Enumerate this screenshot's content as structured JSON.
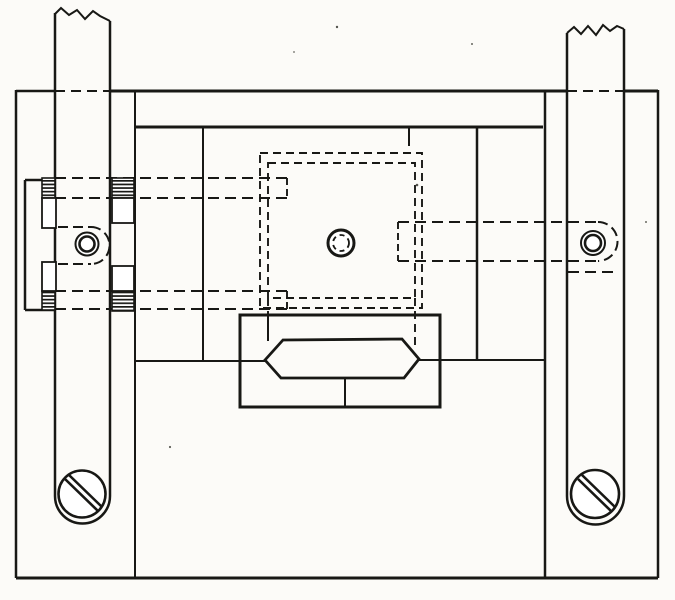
{
  "meta": {
    "description": "Patent-style mechanical line drawing: plan view of a base plate with two vertical slide bars (shown broken at top), a threaded clamp bracket, hidden dashed platform outline with center pivot, and a hexagonal wedge block in a housing",
    "background": "#fcfbf8",
    "ink": "#181815"
  },
  "figure": {
    "width": 675,
    "height": 600,
    "elements": [
      {
        "name": "hidden-rod-upper-top-line",
        "type": "line",
        "x1": 55,
        "y1": 178,
        "x2": 287,
        "y2": 178,
        "dash": "11,6",
        "w": 2
      },
      {
        "name": "hidden-rod-upper-bottom-line",
        "type": "line",
        "x1": 55,
        "y1": 198,
        "x2": 287,
        "y2": 198,
        "dash": "11,6",
        "w": 2
      },
      {
        "name": "hidden-rod-lower-top-line",
        "type": "line",
        "x1": 55,
        "y1": 291,
        "x2": 287,
        "y2": 291,
        "dash": "11,6",
        "w": 2
      },
      {
        "name": "hidden-rod-lower-bottom-line",
        "type": "line",
        "x1": 55,
        "y1": 309,
        "x2": 287,
        "y2": 309,
        "dash": "11,6",
        "w": 2
      },
      {
        "name": "hidden-rod-right-top-line",
        "type": "line",
        "x1": 398,
        "y1": 222,
        "x2": 598,
        "y2": 222,
        "dash": "11,6",
        "w": 2
      },
      {
        "name": "hidden-rod-right-bottom-line",
        "type": "line",
        "x1": 398,
        "y1": 261,
        "x2": 598,
        "y2": 261,
        "dash": "11,6",
        "w": 2
      },
      {
        "name": "hidden-rod-right-end-arc",
        "type": "path",
        "d": "M 598 222 A 19.5 19.5 0 0 1 598 261",
        "dash": "10,5",
        "w": 2
      },
      {
        "name": "hidden-edge-below-right-screw",
        "type": "line",
        "x1": 568,
        "y1": 272,
        "x2": 618,
        "y2": 272,
        "dash": "11,6",
        "w": 2
      },
      {
        "name": "left-screw-hidden-slot-top",
        "type": "line",
        "x1": 58,
        "y1": 227,
        "x2": 91,
        "y2": 227,
        "dash": "10,5",
        "w": 2
      },
      {
        "name": "left-screw-hidden-slot-bottom",
        "type": "line",
        "x1": 58,
        "y1": 264,
        "x2": 91,
        "y2": 264,
        "dash": "10,5",
        "w": 2
      },
      {
        "name": "left-screw-hidden-slot-arc",
        "type": "path",
        "d": "M 91 227 A 18.5 18.5 0 0 1 91 264",
        "dash": "10,5",
        "w": 2
      },
      {
        "name": "platform-hidden-outline-outer",
        "type": "rect",
        "x": 260,
        "y": 153,
        "width": 162,
        "height": 155,
        "dash": "8,5",
        "w": 1.9
      },
      {
        "name": "platform-hidden-outline-inner",
        "type": "rect",
        "x": 268,
        "y": 163,
        "width": 147,
        "height": 135,
        "dash": "8,5",
        "w": 1.9
      },
      {
        "name": "platform-notch-top-left",
        "type": "line",
        "x1": 287,
        "y1": 178,
        "x2": 287,
        "y2": 198,
        "dash": "7,4",
        "w": 1.9
      },
      {
        "name": "platform-notch-bottom-left",
        "type": "line",
        "x1": 287,
        "y1": 291,
        "x2": 287,
        "y2": 309,
        "dash": "7,4",
        "w": 1.9
      },
      {
        "name": "platform-notch-right",
        "type": "line",
        "x1": 398,
        "y1": 222,
        "x2": 398,
        "y2": 261,
        "dash": "7,4",
        "w": 1.9
      },
      {
        "name": "platform-inner-right-extension",
        "type": "line",
        "x1": 415,
        "y1": 298,
        "x2": 415,
        "y2": 345,
        "dash": "8,5",
        "w": 1.9
      },
      {
        "name": "platform-inner-left-extension",
        "type": "line",
        "x1": 268,
        "y1": 298,
        "x2": 268,
        "y2": 315,
        "dash": "8,5",
        "w": 1.9
      },
      {
        "name": "plate-top-edge-hidden-behind-left-bar",
        "type": "line",
        "x1": 55,
        "y1": 91,
        "x2": 110,
        "y2": 91,
        "dash": "10,6",
        "w": 2
      },
      {
        "name": "plate-top-edge-hidden-behind-right-bar",
        "type": "line",
        "x1": 567,
        "y1": 91,
        "x2": 624,
        "y2": 91,
        "dash": "10,6",
        "w": 2
      },
      {
        "name": "plate-top-edge-left-segment",
        "type": "line",
        "x1": 16,
        "y1": 91,
        "x2": 55,
        "y2": 91,
        "w": 2.5
      },
      {
        "name": "plate-top-edge-middle-segment",
        "type": "line",
        "x1": 110,
        "y1": 91,
        "x2": 567,
        "y2": 91,
        "w": 3
      },
      {
        "name": "plate-top-edge-right-segment",
        "type": "line",
        "x1": 624,
        "y1": 91,
        "x2": 658,
        "y2": 91,
        "w": 3
      },
      {
        "name": "plate-left-edge",
        "type": "line",
        "x1": 16,
        "y1": 90,
        "x2": 16,
        "y2": 578,
        "w": 2.5
      },
      {
        "name": "plate-bottom-edge",
        "type": "line",
        "x1": 16,
        "y1": 578,
        "x2": 658,
        "y2": 578,
        "w": 3
      },
      {
        "name": "plate-right-edge",
        "type": "line",
        "x1": 658,
        "y1": 90,
        "x2": 658,
        "y2": 578,
        "w": 2.5
      },
      {
        "name": "plate-inner-left-edge",
        "type": "line",
        "x1": 135,
        "y1": 91,
        "x2": 135,
        "y2": 578,
        "w": 2
      },
      {
        "name": "plate-inner-right-edge",
        "type": "line",
        "x1": 545,
        "y1": 91,
        "x2": 545,
        "y2": 578,
        "w": 2.5
      },
      {
        "name": "top-rail-lower-edge",
        "type": "line",
        "x1": 135,
        "y1": 127,
        "x2": 543,
        "y2": 127,
        "w": 3
      },
      {
        "name": "recess-left-edge",
        "type": "line",
        "x1": 203,
        "y1": 127,
        "x2": 203,
        "y2": 361,
        "w": 2
      },
      {
        "name": "recess-right-edge",
        "type": "line",
        "x1": 477,
        "y1": 127,
        "x2": 477,
        "y2": 360,
        "w": 2.5
      },
      {
        "name": "recess-edge-tick",
        "type": "line",
        "x1": 409,
        "y1": 127,
        "x2": 409,
        "y2": 146,
        "w": 2
      },
      {
        "name": "recess-mid-left-ledge",
        "type": "line",
        "x1": 135,
        "y1": 361,
        "x2": 265,
        "y2": 361,
        "w": 2
      },
      {
        "name": "recess-mid-right-ledge",
        "type": "line",
        "x1": 419,
        "y1": 360,
        "x2": 545,
        "y2": 360,
        "w": 2
      },
      {
        "name": "wedge-housing-outline",
        "type": "rect",
        "x": 240,
        "y": 315,
        "width": 200,
        "height": 92,
        "w": 3
      },
      {
        "name": "wedge-housing-inner-edge",
        "type": "line",
        "x1": 268,
        "y1": 315,
        "x2": 268,
        "y2": 341,
        "w": 2
      },
      {
        "name": "wedge-housing-center-rib",
        "type": "line",
        "x1": 345,
        "y1": 378,
        "x2": 345,
        "y2": 407,
        "w": 2
      },
      {
        "name": "wedge-block-outline",
        "type": "polygon",
        "points": "265,360 283,340 402,339 419,359 404,378 281,378",
        "w": 2.8
      },
      {
        "name": "clamp-bracket-outer-edge",
        "type": "line",
        "x1": 25,
        "y1": 180,
        "x2": 25,
        "y2": 310,
        "w": 2.5
      },
      {
        "name": "clamp-bracket-top-edge",
        "type": "line",
        "x1": 25,
        "y1": 180,
        "x2": 55,
        "y2": 180,
        "w": 2.5
      },
      {
        "name": "clamp-bracket-bottom-edge",
        "type": "line",
        "x1": 25,
        "y1": 310,
        "x2": 55,
        "y2": 310,
        "w": 2.5
      },
      {
        "name": "left-slide-bar-left-edge",
        "type": "line",
        "x1": 55,
        "y1": 13,
        "x2": 55,
        "y2": 496,
        "w": 2.5
      },
      {
        "name": "left-slide-bar-right-edge",
        "type": "line",
        "x1": 110,
        "y1": 21,
        "x2": 110,
        "y2": 496,
        "w": 2.5
      },
      {
        "name": "left-slide-bar-break-line",
        "type": "polyline",
        "points": "55,14 61,8 69,15 77,10 85,19 93,11 100,16 110,21",
        "w": 2
      },
      {
        "name": "left-slide-bar-round-end",
        "type": "path",
        "d": "M 55 496 A 27.5 27.5 0 0 0 110 496",
        "w": 2.5
      },
      {
        "name": "right-slide-bar-left-edge",
        "type": "line",
        "x1": 567,
        "y1": 33,
        "x2": 567,
        "y2": 496,
        "w": 2.5
      },
      {
        "name": "right-slide-bar-right-edge",
        "type": "line",
        "x1": 624,
        "y1": 29,
        "x2": 624,
        "y2": 496,
        "w": 2.5
      },
      {
        "name": "right-slide-bar-break-line",
        "type": "polyline",
        "points": "567,33 574,27 581,34 588,26 596,35 603,25 610,31 617,26 624,29",
        "w": 2
      },
      {
        "name": "right-slide-bar-round-end",
        "type": "path",
        "d": "M 567 496 A 28.5 28.5 0 0 0 624 496",
        "w": 2.5
      },
      {
        "name": "thread-block-upper-left",
        "type": "rect",
        "x": 42,
        "y": 178,
        "width": 13,
        "height": 20,
        "fill": "hatch",
        "w": 1.6
      },
      {
        "name": "thread-block-upper-right",
        "type": "rect",
        "x": 112,
        "y": 178,
        "width": 22,
        "height": 20,
        "fill": "hatch",
        "w": 1.6
      },
      {
        "name": "thread-block-lower-left",
        "type": "rect",
        "x": 42,
        "y": 291,
        "width": 13,
        "height": 19,
        "fill": "hatch",
        "w": 1.6
      },
      {
        "name": "thread-block-lower-right",
        "type": "rect",
        "x": 112,
        "y": 291,
        "width": 22,
        "height": 20,
        "fill": "hatch",
        "w": 1.6
      },
      {
        "name": "shank-box-upper-left",
        "type": "rect",
        "x": 42,
        "y": 198,
        "width": 14,
        "height": 30,
        "fill": "#ffffff",
        "w": 1.8
      },
      {
        "name": "shank-box-upper-right",
        "type": "rect",
        "x": 112,
        "y": 198,
        "width": 22,
        "height": 25,
        "fill": "#ffffff",
        "w": 1.8
      },
      {
        "name": "shank-box-lower-left",
        "type": "rect",
        "x": 42,
        "y": 262,
        "width": 14,
        "height": 29,
        "fill": "#ffffff",
        "w": 1.8
      },
      {
        "name": "shank-box-lower-right",
        "type": "rect",
        "x": 112,
        "y": 266,
        "width": 22,
        "height": 25,
        "fill": "#ffffff",
        "w": 1.8
      },
      {
        "name": "left-guide-screw-outer-ring",
        "type": "circle",
        "cx": 87,
        "cy": 244,
        "r": 11.5,
        "w": 2,
        "fill": "#ffffff"
      },
      {
        "name": "left-guide-screw-inner-ring",
        "type": "circle",
        "cx": 87,
        "cy": 244,
        "r": 7.5,
        "w": 2.6
      },
      {
        "name": "right-guide-screw-outer-ring",
        "type": "circle",
        "cx": 593,
        "cy": 243,
        "r": 12,
        "w": 2,
        "fill": "#ffffff"
      },
      {
        "name": "right-guide-screw-inner-ring",
        "type": "circle",
        "cx": 593,
        "cy": 243,
        "r": 8,
        "w": 2.6
      },
      {
        "name": "center-pivot-outer-ring",
        "type": "circle",
        "cx": 341,
        "cy": 243,
        "r": 13,
        "w": 3,
        "fill": "#ffffff"
      },
      {
        "name": "center-pivot-inner-dashed-ring",
        "type": "circle",
        "cx": 341,
        "cy": 243,
        "r": 8,
        "w": 1.8,
        "dash": "5,4"
      },
      {
        "name": "left-clamp-screw-head",
        "type": "circle",
        "cx": 82,
        "cy": 494,
        "r": 23.5,
        "w": 2.6,
        "fill": "#ffffff"
      },
      {
        "name": "left-clamp-screw-slot-a",
        "type": "line",
        "x1": 65,
        "y1": 479,
        "x2": 98,
        "y2": 511,
        "w": 2.6
      },
      {
        "name": "left-clamp-screw-slot-b",
        "type": "line",
        "x1": 69,
        "y1": 475,
        "x2": 102,
        "y2": 507,
        "w": 2.6
      },
      {
        "name": "right-clamp-screw-head",
        "type": "circle",
        "cx": 595,
        "cy": 494,
        "r": 24,
        "w": 2.6,
        "fill": "#ffffff"
      },
      {
        "name": "right-clamp-screw-slot-a",
        "type": "line",
        "x1": 578,
        "y1": 479,
        "x2": 611,
        "y2": 511,
        "w": 2.6
      },
      {
        "name": "right-clamp-screw-slot-b",
        "type": "line",
        "x1": 582,
        "y1": 475,
        "x2": 615,
        "y2": 507,
        "w": 2.6
      },
      {
        "name": "scan-speck-1",
        "type": "circle",
        "cx": 337,
        "cy": 27,
        "r": 1.2,
        "w": 0,
        "fill": "#555550"
      },
      {
        "name": "scan-speck-2",
        "type": "circle",
        "cx": 472,
        "cy": 44,
        "r": 1.0,
        "w": 0,
        "fill": "#66665f"
      },
      {
        "name": "scan-speck-3",
        "type": "circle",
        "cx": 417,
        "cy": 185,
        "r": 1.3,
        "w": 0,
        "fill": "#55554e"
      },
      {
        "name": "scan-speck-4",
        "type": "circle",
        "cx": 646,
        "cy": 222,
        "r": 1.0,
        "w": 0,
        "fill": "#6a6a63"
      },
      {
        "name": "scan-speck-5",
        "type": "circle",
        "cx": 294,
        "cy": 52,
        "r": 0.9,
        "w": 0,
        "fill": "#6a6a63"
      },
      {
        "name": "scan-speck-6",
        "type": "circle",
        "cx": 170,
        "cy": 447,
        "r": 1.1,
        "w": 0,
        "fill": "#60605a"
      }
    ]
  }
}
